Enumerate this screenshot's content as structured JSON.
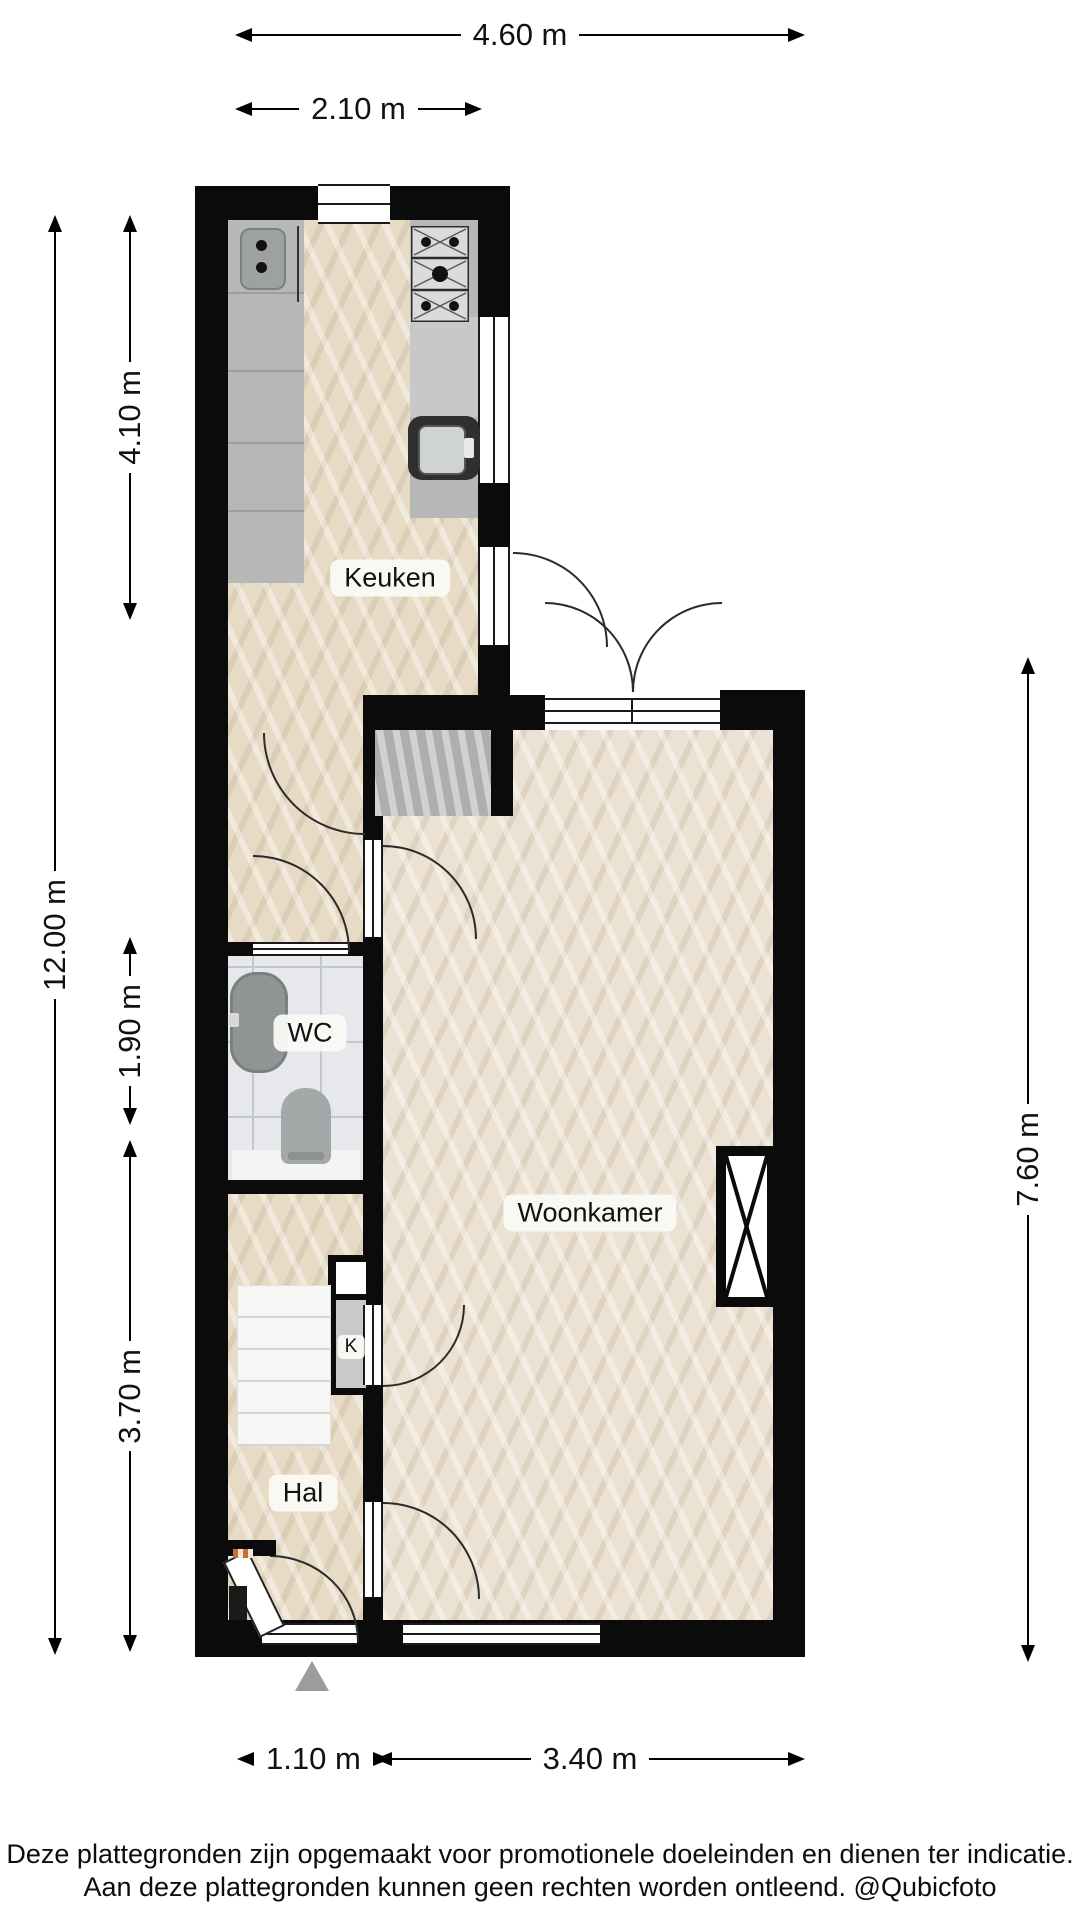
{
  "rooms": {
    "keuken": "Keuken",
    "wc": "WC",
    "woonkamer": "Woonkamer",
    "hal": "Hal",
    "kast": "K"
  },
  "dimensions": {
    "top_total": "4.60 m",
    "top_kitchen": "2.10 m",
    "left_total": "12.00 m",
    "left_kitchen": "4.10 m",
    "left_wc": "1.90 m",
    "left_hal": "3.70 m",
    "right_living": "7.60 m",
    "bottom_entrance": "1.10 m",
    "bottom_living": "3.40 m"
  },
  "footer": {
    "line1": "Deze plattegronden zijn opgemaakt voor promotionele doeleinden en dienen ter indicatie.",
    "line2": "Aan deze plattegronden kunnen geen rechten worden ontleend. @Qubicfoto"
  },
  "colors": {
    "wall": "#0b0b0b",
    "wood": "#e8dbc6",
    "wood_light": "#ece2d3",
    "tile": "#e6e8eb",
    "counter": "#b5b8b6",
    "stove": "#d9dcda",
    "stairs": "#f6f6f4",
    "stair_box": "#b9b9b9",
    "marker": "#9c9c9c",
    "arc": "#2b2b2b"
  }
}
